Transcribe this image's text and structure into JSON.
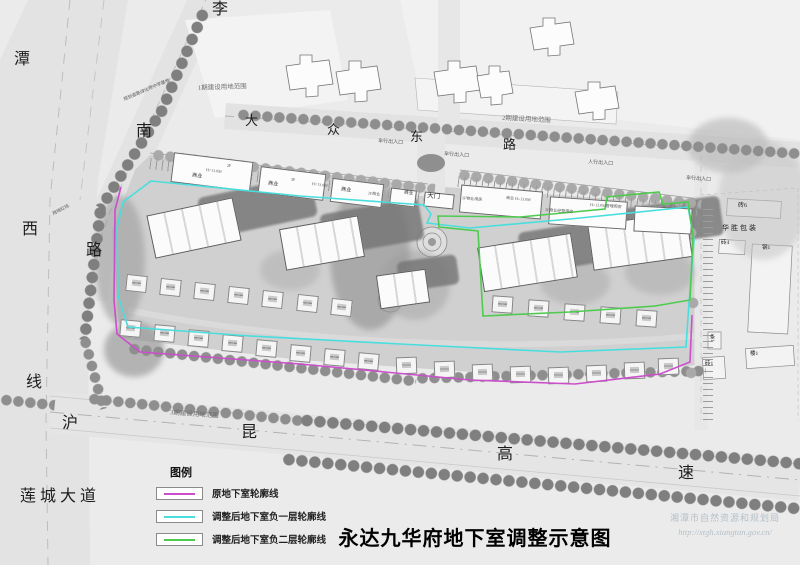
{
  "title": "永达九华府地下室调整示意图",
  "watermark": {
    "agency": "湘潭市自然资源和规划局",
    "url": "http://xtgh.xiangtan.gov.cn/"
  },
  "legend": {
    "heading": "图例",
    "items": [
      {
        "label": "原地下室轮廓线",
        "color": "#cb4ecb"
      },
      {
        "label": "调整后地下室负一层轮廓线",
        "color": "#49dede"
      },
      {
        "label": "调整后地下室负二层轮廓线",
        "color": "#4ecb4e"
      }
    ]
  },
  "roads": {
    "left_vertical": [
      "潭",
      "西",
      "线"
    ],
    "curved": [
      "李",
      "南",
      "路"
    ],
    "east_road": [
      "大",
      "众",
      "东",
      "路"
    ],
    "expressway": [
      "沪",
      "昆",
      "高",
      "速"
    ],
    "avenue": "莲城大道"
  },
  "phases": {
    "phase1": "1期建设用地范围",
    "phase2": "2期建设用地范围",
    "phase3": "3期建设用地范围"
  },
  "entrances": {
    "vehicle1": "车行出入口",
    "vehicle2": "车行出入口",
    "pedestrian": "人行出入口",
    "vehicle3": "车行出入口",
    "gate": "大门"
  },
  "shops": {
    "s1": "商业",
    "s1_floor": "2F",
    "s1_height": "H=13.0M",
    "s2": "商业",
    "s2_floor": "3F",
    "s3": "商业",
    "s3_height": "H=13.0M",
    "s4": "2F商业",
    "s5": "商业",
    "p1": "2F物业用房",
    "p2": "商业 H=13.0M",
    "p3": "2F物业经营用房",
    "p4": "H=13.0M管理用房"
  },
  "industrial": {
    "b1": "砖6",
    "b2": "华胜包装",
    "b3": "砖4",
    "b4": "钢1",
    "b5": "条1",
    "b6": "楼1",
    "b7": "砖1"
  },
  "notes": {
    "school": "规划道路绿化带中学基地",
    "redline": "用地红线"
  },
  "outline_colors": {
    "original": "#cb4ecb",
    "level_minus1": "#49dede",
    "level_minus2": "#4ecb4e"
  }
}
